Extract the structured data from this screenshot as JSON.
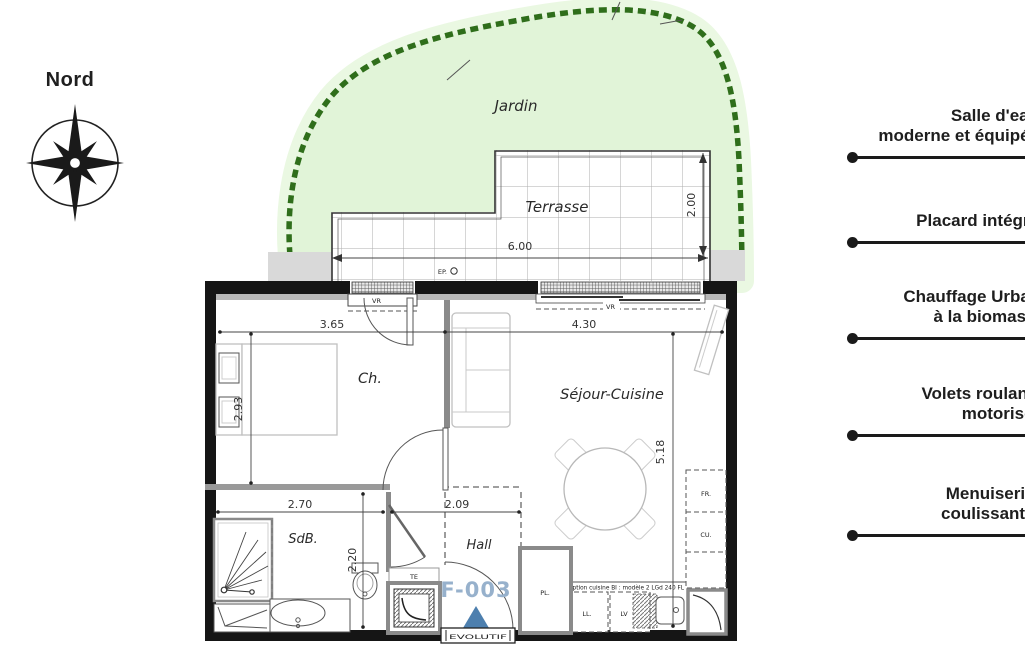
{
  "compass": {
    "label": "Nord"
  },
  "garden": {
    "label": "Jardin"
  },
  "terrace": {
    "label": "Terrasse",
    "width_dim": "6.00",
    "depth_dim": "2.00",
    "drain": "EP."
  },
  "rooms": {
    "bedroom": {
      "label": "Ch.",
      "width_dim": "3.65",
      "height_dim": "2.93"
    },
    "living": {
      "label": "Séjour-Cuisine",
      "width_dim": "4.30",
      "height_dim": "5.18"
    },
    "bathroom": {
      "label": "SdB.",
      "width_dim": "2.70",
      "height_dim": "2.20"
    },
    "hall": {
      "label": "Hall",
      "width_dim": "2.09"
    }
  },
  "unit": {
    "number": "F-003",
    "threshold": "EVOLUTIF"
  },
  "equipment": {
    "shutter": "VR",
    "electrical": "TE",
    "closet": "PL.",
    "washer": "LL.",
    "dishwasher": "LV",
    "fridge": "FR.",
    "cooking": "CU.",
    "kitchen_note": "Option cuisine BI : modèle 2 LGd 240 FL"
  },
  "features": {
    "items": [
      {
        "line1": "Salle d'eau",
        "line2": "moderne et équipée"
      },
      {
        "line1": "Placard intégré",
        "line2": ""
      },
      {
        "line1": "Chauffage Urbain",
        "line2": "à la biomasse"
      },
      {
        "line1": "Volets roulants",
        "line2": "motorisés"
      },
      {
        "line1": "Menuiseries",
        "line2": "coulissantes"
      }
    ]
  },
  "colors": {
    "wall": "#151515",
    "hedge": "#2f6e1b",
    "garden_fill": "#e1f4d8",
    "garden_halo": "#eaf8e2",
    "accent_blue": "#4d7fae",
    "unit_blue": "#97b1cc",
    "feature_text": "#1e1e1e",
    "feature_rule": "#1a1a1a"
  }
}
